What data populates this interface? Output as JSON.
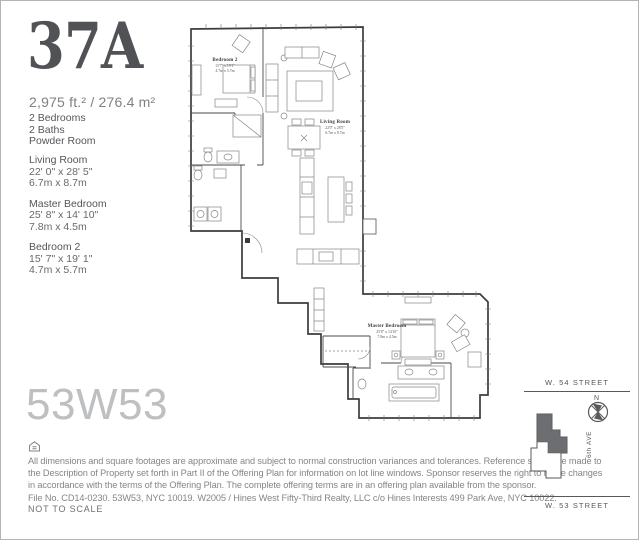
{
  "unit": {
    "number": "37A",
    "area": "2,975 ft.² / 276.4 m²",
    "features": [
      "2 Bedrooms",
      "2 Baths",
      "Powder Room"
    ],
    "rooms": [
      {
        "name": "Living Room",
        "imperial": "22' 0\" x 28' 5\"",
        "metric": "6.7m x 8.7m"
      },
      {
        "name": "Master Bedroom",
        "imperial": "25' 8\" x 14' 10\"",
        "metric": "7.8m x 4.5m"
      },
      {
        "name": "Bedroom 2",
        "imperial": "15' 7\" x 19' 1\"",
        "metric": "4.7m x 5.7m"
      }
    ]
  },
  "building": {
    "name": "53W53"
  },
  "plan": {
    "rooms": [
      {
        "name": "Bedroom 2",
        "imperial": "15'7\" x 19'1\"",
        "metric": "4.7m x 5.7m"
      },
      {
        "name": "Living Room",
        "imperial": "22'0\" x 28'5\"",
        "metric": "6.7m x 8.7m"
      },
      {
        "name": "Master Bedroom",
        "imperial": "25'8\" x 14'10\"",
        "metric": "7.8m x 4.5m"
      }
    ]
  },
  "keyplan": {
    "street_top": "W. 54 STREET",
    "street_bottom": "W. 53 STREET",
    "avenue": "6th AVE",
    "compass_label": "N"
  },
  "legal": {
    "lines": [
      "All dimensions and square footages are approximate and subject to normal construction variances and tolerances. Reference should be made to",
      "the Description of Property set forth in Part II of the Offering Plan for information on lot line windows. Sponsor reserves the right to make changes",
      "in accordance with the terms of the Offering Plan. The complete offering terms are in an offering plan available from the sponsor.",
      "File No. CD14-0230. 53W53, NYC 10019. W2005 / Hines West Fifty-Third Realty, LLC c/o Hines Interests 499 Park Ave, NYC 10022."
    ],
    "scale_note": "NOT TO SCALE"
  }
}
